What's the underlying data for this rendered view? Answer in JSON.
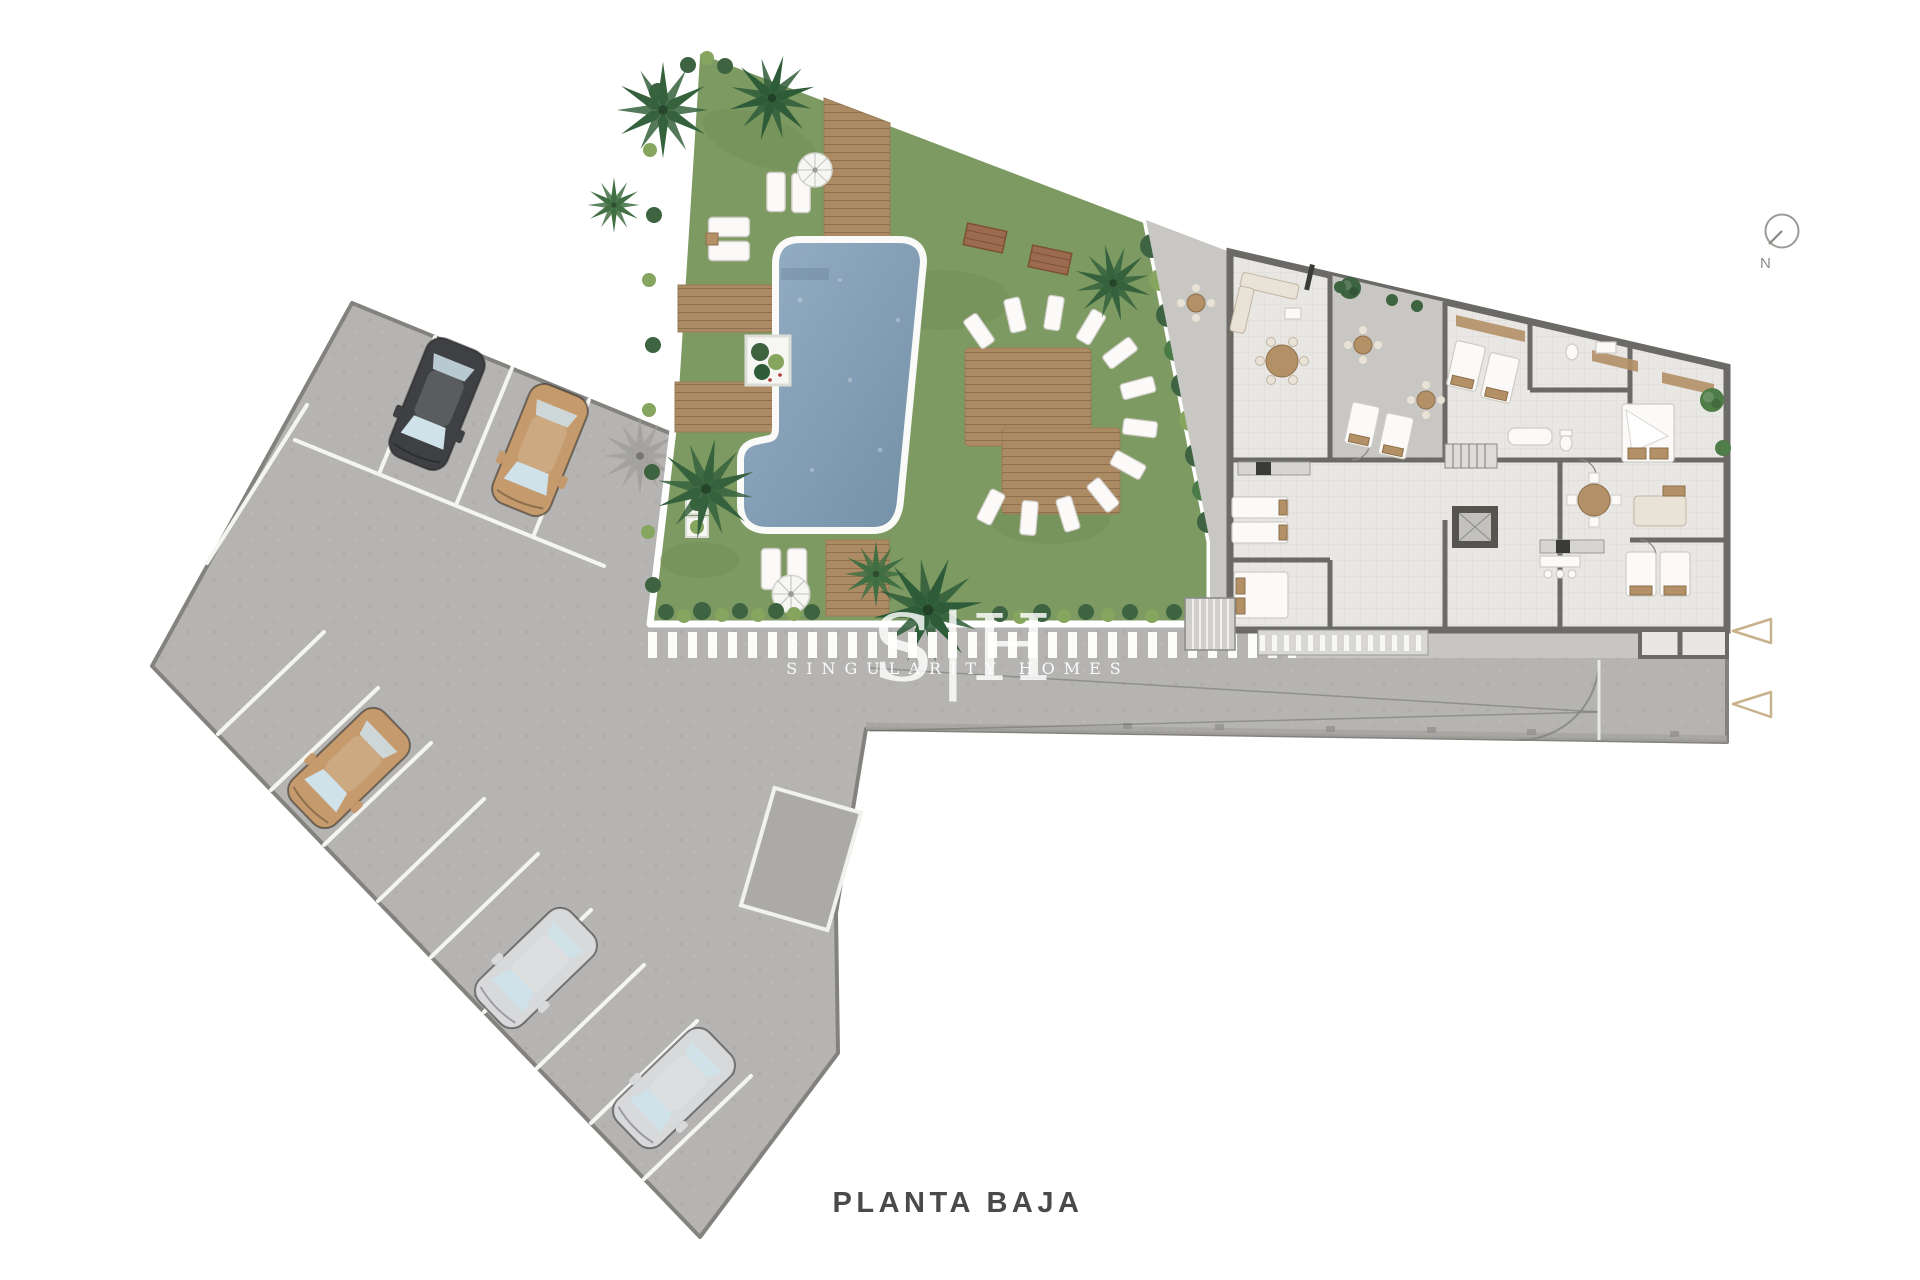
{
  "plan": {
    "title": "PLANTA BAJA"
  },
  "compass": {
    "label": "N"
  },
  "watermark": {
    "initials": "S|H",
    "name": "SINGULARITY HOMES"
  },
  "colors": {
    "bg": "#ffffff",
    "pavement": "#b5b4b2",
    "pavement-border": "#83827e",
    "pavement-mark": "#abaaa7",
    "stall-line": "#f4f4f1",
    "curb": "#a6a5a2",
    "dash-white": "#fbfbf9",
    "grass": "#7e9a63",
    "grass-dark": "#6d8b54",
    "garden-border": "#ffffff",
    "hedge": "#3d6340",
    "bush-light": "#86a55f",
    "palm-green": "#35623c",
    "palm-shadow": "#a2a19e",
    "deck": "#ac8a63",
    "deck-edge": "#977e58",
    "pool-rim": "#fafaf8",
    "pool-light": "#95aec5",
    "pool-deep": "#7390a6",
    "floor": "#e8e7e4",
    "terrace": "#c8c7c4",
    "wall": "#6b6a66",
    "furn-white": "#fbfaf8",
    "furn-beige": "#e9e2d6",
    "furn-tan": "#b39066",
    "appliance": "#3a3a38",
    "car-dark": "#3f4043",
    "car-tan": "#c59a6d",
    "car-silver": "#d8d9db",
    "glass": "#cfe2ea",
    "triangle": "#c7b28b",
    "title": "#4b4a48",
    "compass": "#8a8a86",
    "watermark": "#ffffff"
  },
  "parking": {
    "cars": [
      {
        "shade": "dark",
        "hex": "#3f4043"
      },
      {
        "shade": "tan",
        "hex": "#c59a6d"
      },
      {
        "shade": "tan",
        "hex": "#c59a6d"
      },
      {
        "shade": "silver",
        "hex": "#d8d9db"
      },
      {
        "shade": "silver",
        "hex": "#d8d9db"
      }
    ]
  },
  "markers": {
    "entrance_arrow_count": 2
  }
}
